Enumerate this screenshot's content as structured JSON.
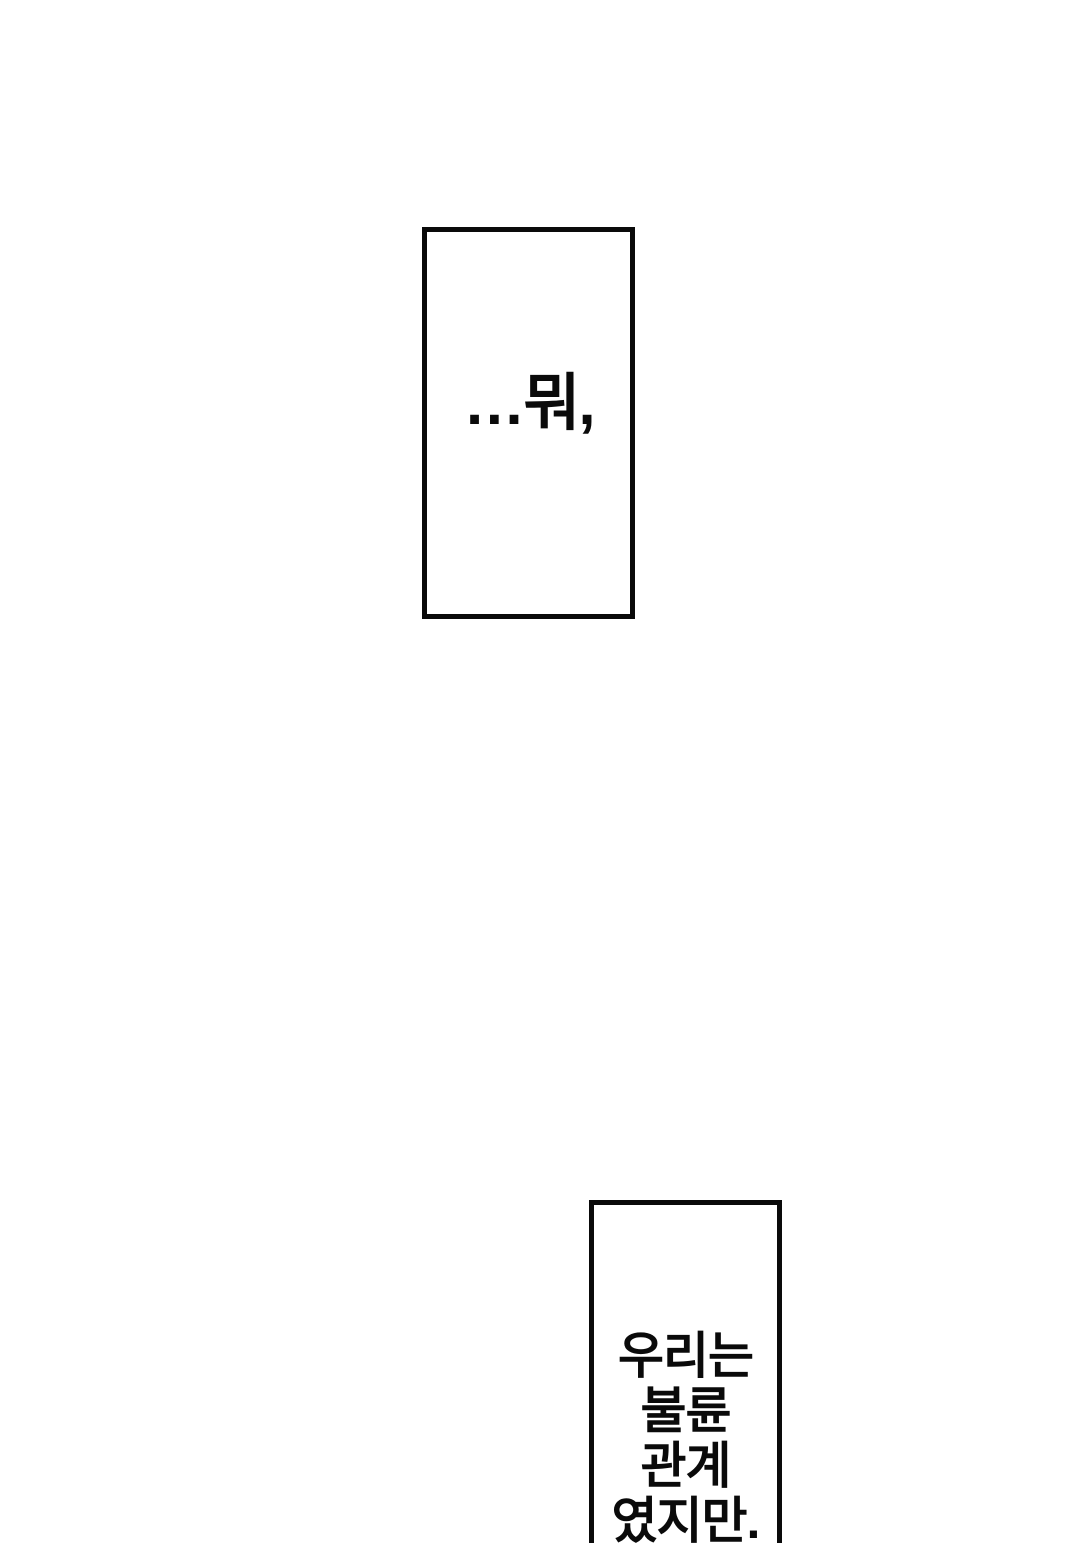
{
  "page": {
    "background_color": "#ffffff",
    "ink_color": "#0a0a0a"
  },
  "panels": [
    {
      "id": "caption-top",
      "text": "…뭐,",
      "border_color": "#0a0a0a",
      "fill_color": "#ffffff"
    },
    {
      "id": "caption-bottom",
      "text": "우리는 불륜 관계 였지만.",
      "lines": [
        "우리는",
        "불륜",
        "관계",
        "였지만."
      ],
      "border_color": "#0a0a0a",
      "fill_color": "#ffffff",
      "clipped_at_page_bottom": true
    }
  ]
}
